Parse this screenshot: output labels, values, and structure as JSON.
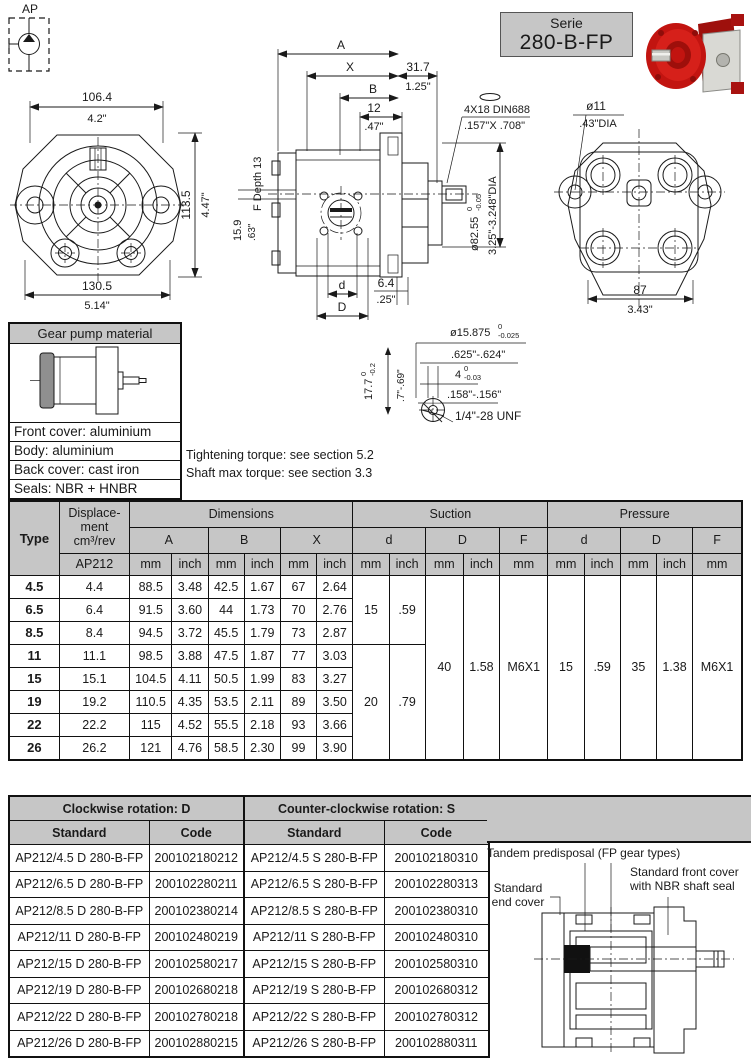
{
  "header": {
    "ap_label": "AP",
    "serie_line1": "Serie",
    "serie_line2": "280-B-FP"
  },
  "front_view": {
    "w_mm": "106.4",
    "w_in": "4.2\"",
    "h_mm": "113.5",
    "h_in": "4.47\"",
    "b_mm": "130.5",
    "b_in": "5.14\""
  },
  "side_view": {
    "a": "A",
    "x": "X",
    "b": "B",
    "len_mm": "31.7",
    "len_in": "1.25\"",
    "plate_mm": "12",
    "plate_in": ".47\"",
    "key_note": "4X18 DIN6885",
    "key_note_in": ".157\"X .708\"",
    "f_depth": "F Depth 13",
    "port_mm": "15.9",
    "port_in": ".63\"",
    "pilot_dia": "ø82.55",
    "pilot_tol_top": "0",
    "pilot_tol_bot": "-0.05",
    "pilot_in": "3.25\"-3.248\"DIA",
    "d_small": "d",
    "d_big": "D",
    "off_mm": "6.4",
    "off_in": ".25\""
  },
  "back_view": {
    "hole_dia": "ø11",
    "hole_in": ".43\"DIA",
    "w_mm": "87",
    "w_in": "3.43\""
  },
  "shaft_detail": {
    "dia": "ø15.875",
    "dia_tol_top": "0",
    "dia_tol_bot": "-0.025",
    "dia_in": ".625\"-.624\"",
    "key": "4",
    "key_tol_top": "0",
    "key_tol_bot": "-0.03",
    "key_in": ".158\"-.156\"",
    "h": "17.7",
    "h_tol_top": "0",
    "h_tol_bot": "-0.2",
    "h_in": ".7\"-.69\"",
    "thread": "1/4\"-28 UNF"
  },
  "material_box": {
    "title": "Gear pump material",
    "front_cover": "Front cover: aluminium",
    "body": "Body: aluminium",
    "back_cover": "Back cover: cast iron",
    "seals": "Seals: NBR + HNBR"
  },
  "notes": {
    "tightening": "Tightening torque: see section 5.2",
    "shaft": "Shaft max torque: see section 3.3"
  },
  "spec_table": {
    "headers": {
      "type": "Type",
      "disp_l1": "Displace-",
      "disp_l2": "ment",
      "disp_l3": "cm³/rev",
      "ap212": "AP212",
      "dimensions": "Dimensions",
      "suction": "Suction",
      "pressure": "Pressure",
      "a": "A",
      "b": "B",
      "x": "X",
      "d_small": "d",
      "d_big": "D",
      "f": "F",
      "mm": "mm",
      "inch": "inch"
    },
    "rows": [
      {
        "type": "4.5",
        "disp": "4.4",
        "a_mm": "88.5",
        "a_in": "3.48",
        "b_mm": "42.5",
        "b_in": "1.67",
        "x_mm": "67",
        "x_in": "2.64"
      },
      {
        "type": "6.5",
        "disp": "6.4",
        "a_mm": "91.5",
        "a_in": "3.60",
        "b_mm": "44",
        "b_in": "1.73",
        "x_mm": "70",
        "x_in": "2.76"
      },
      {
        "type": "8.5",
        "disp": "8.4",
        "a_mm": "94.5",
        "a_in": "3.72",
        "b_mm": "45.5",
        "b_in": "1.79",
        "x_mm": "73",
        "x_in": "2.87"
      },
      {
        "type": "11",
        "disp": "11.1",
        "a_mm": "98.5",
        "a_in": "3.88",
        "b_mm": "47.5",
        "b_in": "1.87",
        "x_mm": "77",
        "x_in": "3.03"
      },
      {
        "type": "15",
        "disp": "15.1",
        "a_mm": "104.5",
        "a_in": "4.11",
        "b_mm": "50.5",
        "b_in": "1.99",
        "x_mm": "83",
        "x_in": "3.27"
      },
      {
        "type": "19",
        "disp": "19.2",
        "a_mm": "110.5",
        "a_in": "4.35",
        "b_mm": "53.5",
        "b_in": "2.11",
        "x_mm": "89",
        "x_in": "3.50"
      },
      {
        "type": "22",
        "disp": "22.2",
        "a_mm": "115",
        "a_in": "4.52",
        "b_mm": "55.5",
        "b_in": "2.18",
        "x_mm": "93",
        "x_in": "3.66"
      },
      {
        "type": "26",
        "disp": "26.2",
        "a_mm": "121",
        "a_in": "4.76",
        "b_mm": "58.5",
        "b_in": "2.30",
        "x_mm": "99",
        "x_in": "3.90"
      }
    ],
    "merged": {
      "s_d1_mm": "15",
      "s_d1_in": ".59",
      "s_d2_mm": "20",
      "s_d2_in": ".79",
      "s_D_mm": "40",
      "s_D_in": "1.58",
      "s_f": "M6X1",
      "p_d_mm": "15",
      "p_d_in": ".59",
      "p_D_mm": "35",
      "p_D_in": "1.38",
      "p_f": "M6X1"
    }
  },
  "order_table": {
    "headers": {
      "cw": "Clockwise rotation: D",
      "ccw": "Counter-clockwise rotation: S",
      "standard": "Standard",
      "code": "Code"
    },
    "rows": [
      {
        "cw_std": "AP212/4.5 D 280-B-FP",
        "cw_code": "200102180212",
        "ccw_std": "AP212/4.5 S 280-B-FP",
        "ccw_code": "200102180310"
      },
      {
        "cw_std": "AP212/6.5 D 280-B-FP",
        "cw_code": "200102280211",
        "ccw_std": "AP212/6.5 S 280-B-FP",
        "ccw_code": "200102280313"
      },
      {
        "cw_std": "AP212/8.5 D 280-B-FP",
        "cw_code": "200102380214",
        "ccw_std": "AP212/8.5 S 280-B-FP",
        "ccw_code": "200102380310"
      },
      {
        "cw_std": "AP212/11 D 280-B-FP",
        "cw_code": "200102480219",
        "ccw_std": "AP212/11 S 280-B-FP",
        "ccw_code": "200102480310"
      },
      {
        "cw_std": "AP212/15 D 280-B-FP",
        "cw_code": "200102580217",
        "ccw_std": "AP212/15 S 280-B-FP",
        "ccw_code": "200102580310"
      },
      {
        "cw_std": "AP212/19 D 280-B-FP",
        "cw_code": "200102680218",
        "ccw_std": "AP212/19 S 280-B-FP",
        "ccw_code": "200102680312"
      },
      {
        "cw_std": "AP212/22 D 280-B-FP",
        "cw_code": "200102780218",
        "ccw_std": "AP212/22 S 280-B-FP",
        "ccw_code": "200102780312"
      },
      {
        "cw_std": "AP212/26 D 280-B-FP",
        "cw_code": "200102880215",
        "ccw_std": "AP212/26 S 280-B-FP",
        "ccw_code": "200102880311"
      }
    ]
  },
  "cross_section": {
    "tandem": "Tandem predisposal (FP gear types)",
    "fc1": "Standard front cover",
    "fc2": "with NBR shaft seal",
    "ec1": "Standard",
    "ec2": "end cover"
  },
  "colors": {
    "header_gray": "#c6c6c6",
    "pump_red": "#c91812"
  }
}
